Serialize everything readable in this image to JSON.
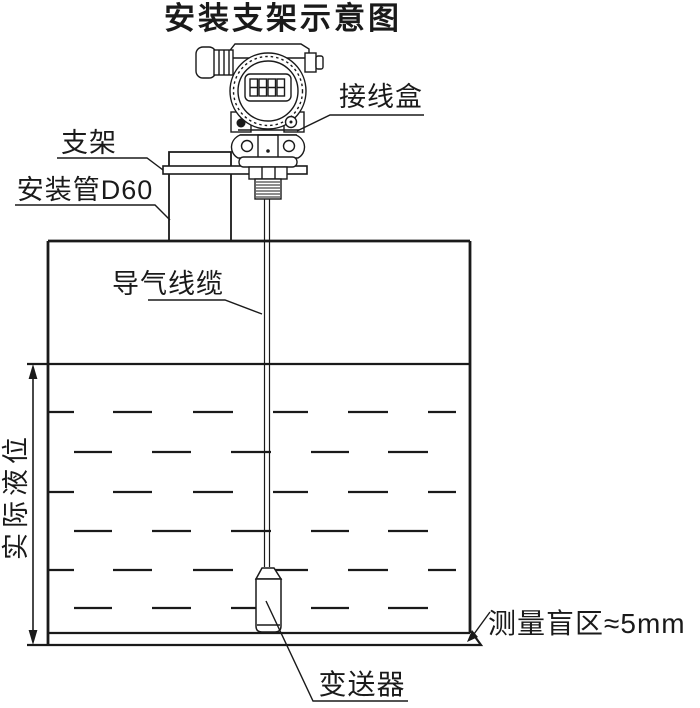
{
  "title": "安装支架示意图",
  "labels": {
    "junction_box": "接线盒",
    "bracket": "支架",
    "mounting_pipe": "安装管D60",
    "air_cable": "导气线缆",
    "actual_level": "实际液位",
    "blind_zone": "测量盲区≈5mm",
    "transmitter": "变送器"
  },
  "device": {
    "display_icon": "lcd-8888-display"
  },
  "colors": {
    "line": "#1a1a1a",
    "background": "#ffffff"
  }
}
